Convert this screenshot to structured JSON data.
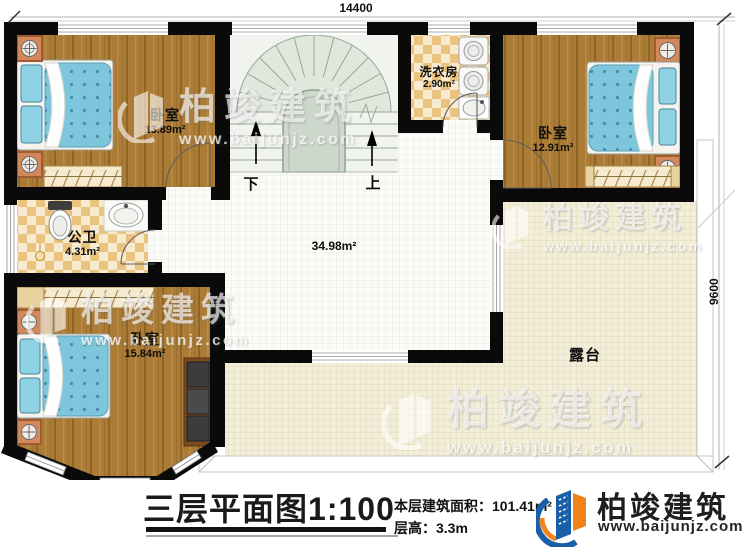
{
  "plan": {
    "dim_top": "14400",
    "dim_right": "9600",
    "rooms": {
      "bedroom_tl": {
        "name": "卧室",
        "area": "13.89m²"
      },
      "bathroom": {
        "name": "公卫",
        "area": "4.31m²"
      },
      "bedroom_bl": {
        "name": "卧室",
        "area": "15.84m²"
      },
      "laundry": {
        "name": "洗衣房",
        "area": "2.90m²"
      },
      "bedroom_tr": {
        "name": "卧室",
        "area": "12.91m²"
      },
      "hall": {
        "area": "34.98m²"
      },
      "terrace": {
        "name": "露台"
      }
    },
    "stairs": {
      "down": "下",
      "up": "上"
    }
  },
  "footer": {
    "plan_title": "三层平面图",
    "plan_scale": "1:100",
    "floor_area_label": "本层建筑面积：",
    "floor_area_value": "101.41m²",
    "floor_height_label": "层高：",
    "floor_height_value": "3.3m"
  },
  "brand": {
    "name": "柏竣建筑",
    "website": "www.baijunjz.com"
  },
  "watermark": {
    "name": "柏竣建筑",
    "website": "www.baijunjz.com"
  },
  "colors": {
    "wall": "#0a0a0a",
    "wood": "#ac7c36",
    "mattress": "#7ec6db",
    "checker": "#eac47f",
    "terrace": "#f2eeda",
    "stair": "#e0e7dd",
    "brand_blue": "#1a5ea8",
    "brand_orange": "#f08418"
  }
}
